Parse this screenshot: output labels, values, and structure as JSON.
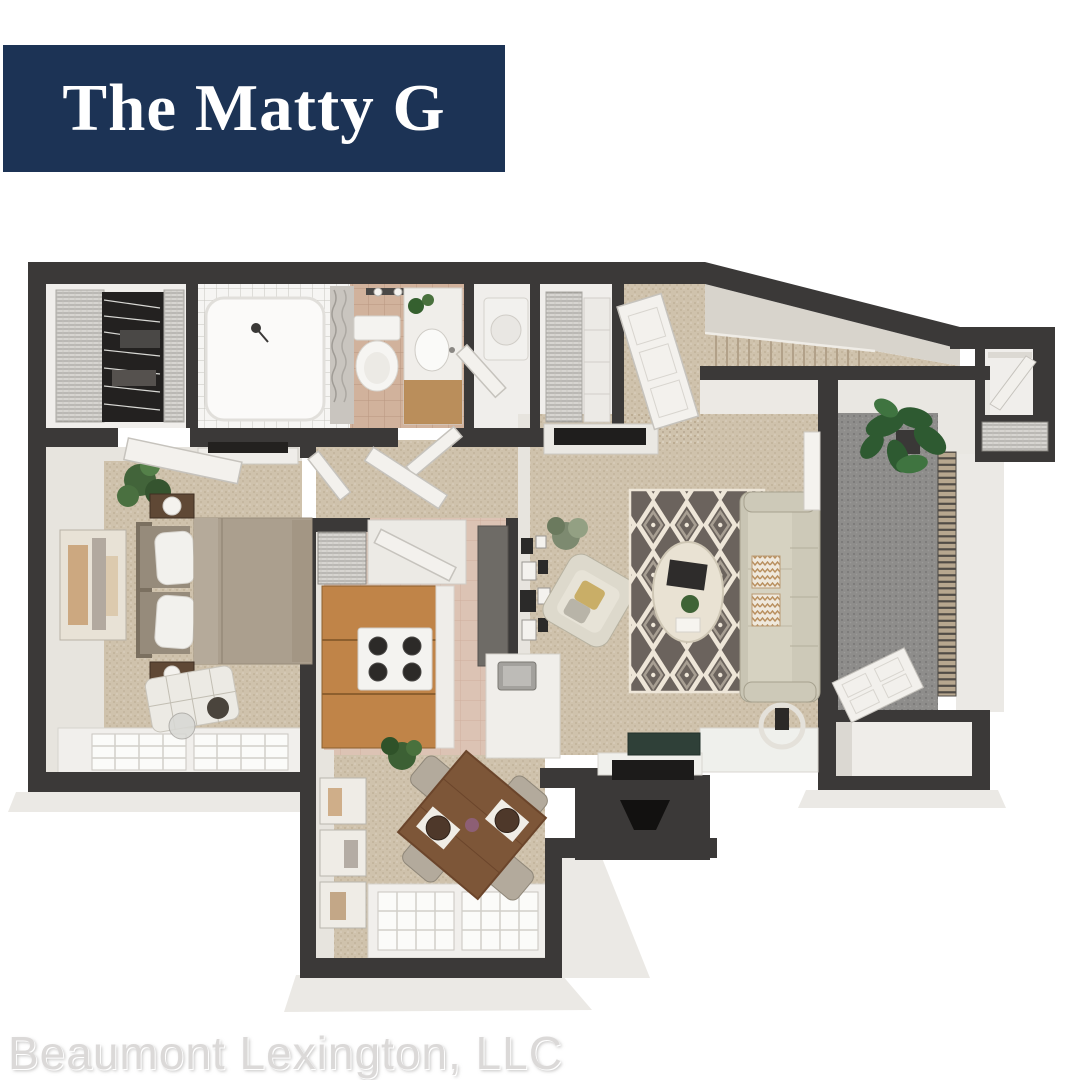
{
  "banner": {
    "title": "The Matty G"
  },
  "footer": {
    "company": "Beaumont Lexington, LLC"
  },
  "colors": {
    "banner_bg": "#1c3355",
    "banner_text": "#ffffff",
    "footer_text": "#dbd9d8",
    "wall": "#3b3938",
    "wall_face": "#e7e4de",
    "carpet": "#cfc2ac",
    "bath_tile": "#d1b29c",
    "kitchen_tile": "#dcc3b4",
    "white_floor": "#f0eeeb",
    "balcony_floor": "#8e8d8b",
    "wood_cabinet": "#c08448",
    "wood_table": "#7d5638",
    "rug_dark": "#6b635d",
    "rug_cream": "#eee6d8",
    "sofa": "#c9c5b4",
    "plant_green": "#35602f",
    "appliance_white": "#f4f3f0"
  }
}
